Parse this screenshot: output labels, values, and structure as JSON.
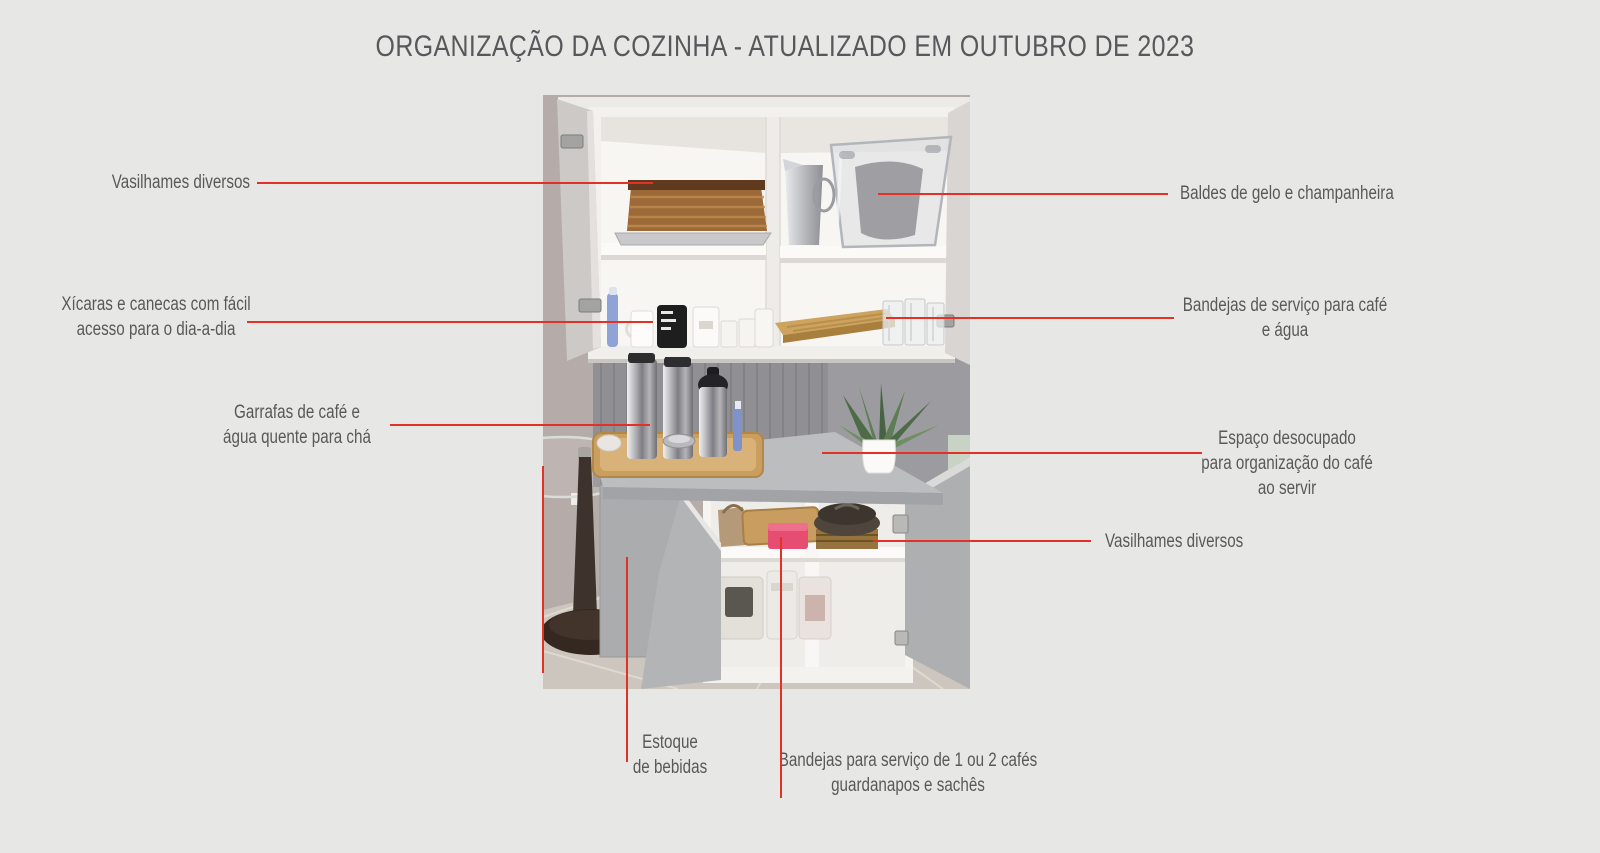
{
  "title": "ORGANIZAÇÃO DA COZINHA - ATUALIZADO EM OUTUBRO DE 2023",
  "annotations": {
    "vasilhames_top": {
      "lines": [
        "Vasilhames diversos"
      ]
    },
    "xicaras": {
      "lines": [
        "Xícaras e canecas com fácil",
        "acesso para o dia-a-dia"
      ]
    },
    "garrafas": {
      "lines": [
        "Garrafas de café e",
        "água quente para chá"
      ]
    },
    "baldes": {
      "lines": [
        "Baldes de gelo e champanheira"
      ]
    },
    "bandejas_servico": {
      "lines": [
        "Bandejas de serviço para café",
        "e água"
      ]
    },
    "espaco": {
      "lines": [
        "Espaço desocupado",
        "para organização do café",
        "ao servir"
      ]
    },
    "vasilhames_bottom": {
      "lines": [
        "Vasilhames diversos"
      ]
    },
    "estoque": {
      "lines": [
        "Estoque",
        "de bebidas"
      ]
    },
    "bandejas_1ou2": {
      "lines": [
        "Bandejas para serviço de 1 ou 2 cafés",
        "guardanapos e sachês"
      ]
    }
  },
  "colors": {
    "background": "#e7e7e5",
    "text": "#58595a",
    "annotation_line_red": "#e23126"
  }
}
